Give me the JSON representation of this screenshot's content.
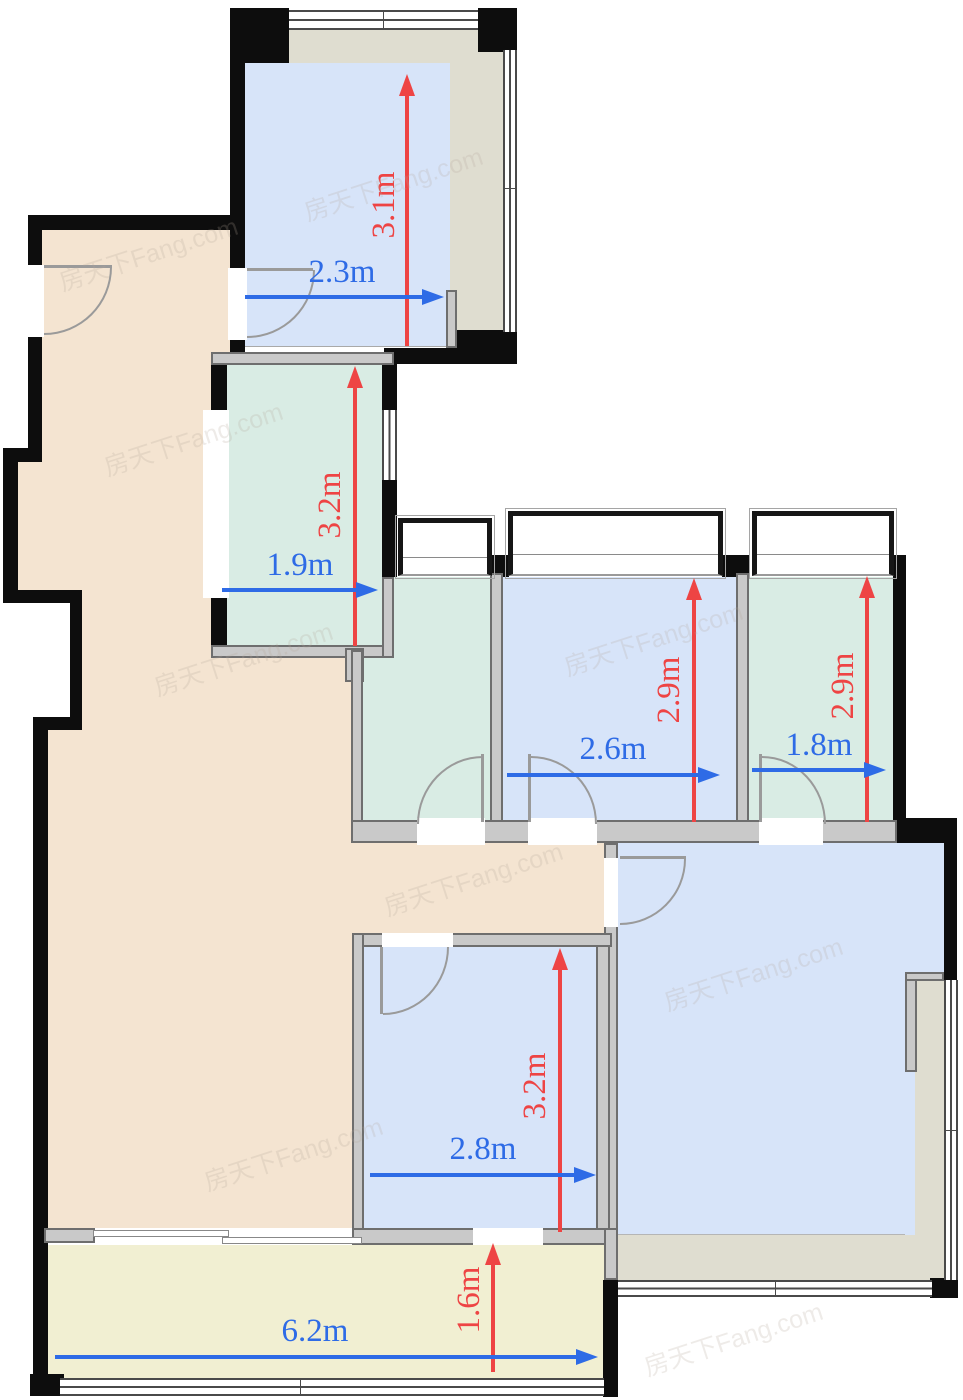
{
  "floorplan": {
    "watermark_text": "房天下Fang.com",
    "colors": {
      "wall_black": "#0d0d0d",
      "wall_gray": "#6e6e6e",
      "room_beige": "#f4e4d1",
      "room_blue": "#d7e4f9",
      "room_mint": "#d9ece4",
      "room_olive": "#dfddd0",
      "balcony_yellow": "#f1efd2",
      "dimension_red": "#ee4444",
      "dimension_blue": "#2e6be6"
    },
    "rooms": [
      {
        "id": "top-bedroom",
        "width_label": "2.3m",
        "height_label": "3.1m"
      },
      {
        "id": "upper-room",
        "width_label": "1.9m",
        "height_label": "3.2m"
      },
      {
        "id": "middle-bedroom",
        "width_label": "2.6m",
        "height_label": "2.9m"
      },
      {
        "id": "right-room",
        "width_label": "1.8m",
        "height_label": "2.9m"
      },
      {
        "id": "lower-bedroom",
        "width_label": "2.8m",
        "height_label": "3.2m"
      },
      {
        "id": "balcony",
        "width_label": "6.2m",
        "height_label": "1.6m"
      }
    ]
  }
}
